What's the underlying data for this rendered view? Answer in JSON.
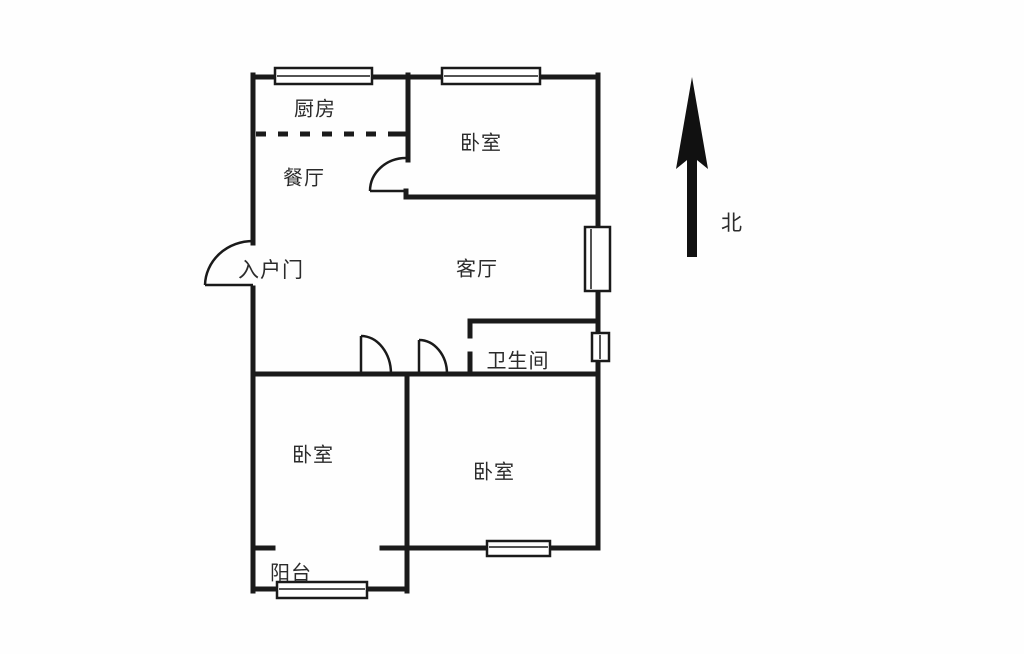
{
  "diagram_type": "apartment-floor-plan",
  "colors": {
    "line": "#1a1a1a",
    "background": "#ffffff",
    "text": "#2b2b2b"
  },
  "compass": {
    "label": "北",
    "direction": "up"
  },
  "rooms": {
    "kitchen": {
      "label": "厨房"
    },
    "dining": {
      "label": "餐厅"
    },
    "bedroom_top": {
      "label": "卧室"
    },
    "living": {
      "label": "客厅"
    },
    "entry_door": {
      "label": "入户门"
    },
    "bathroom": {
      "label": "卫生间"
    },
    "bedroom_left": {
      "label": "卧室"
    },
    "bedroom_right": {
      "label": "卧室"
    },
    "balcony": {
      "label": "阳台"
    }
  }
}
